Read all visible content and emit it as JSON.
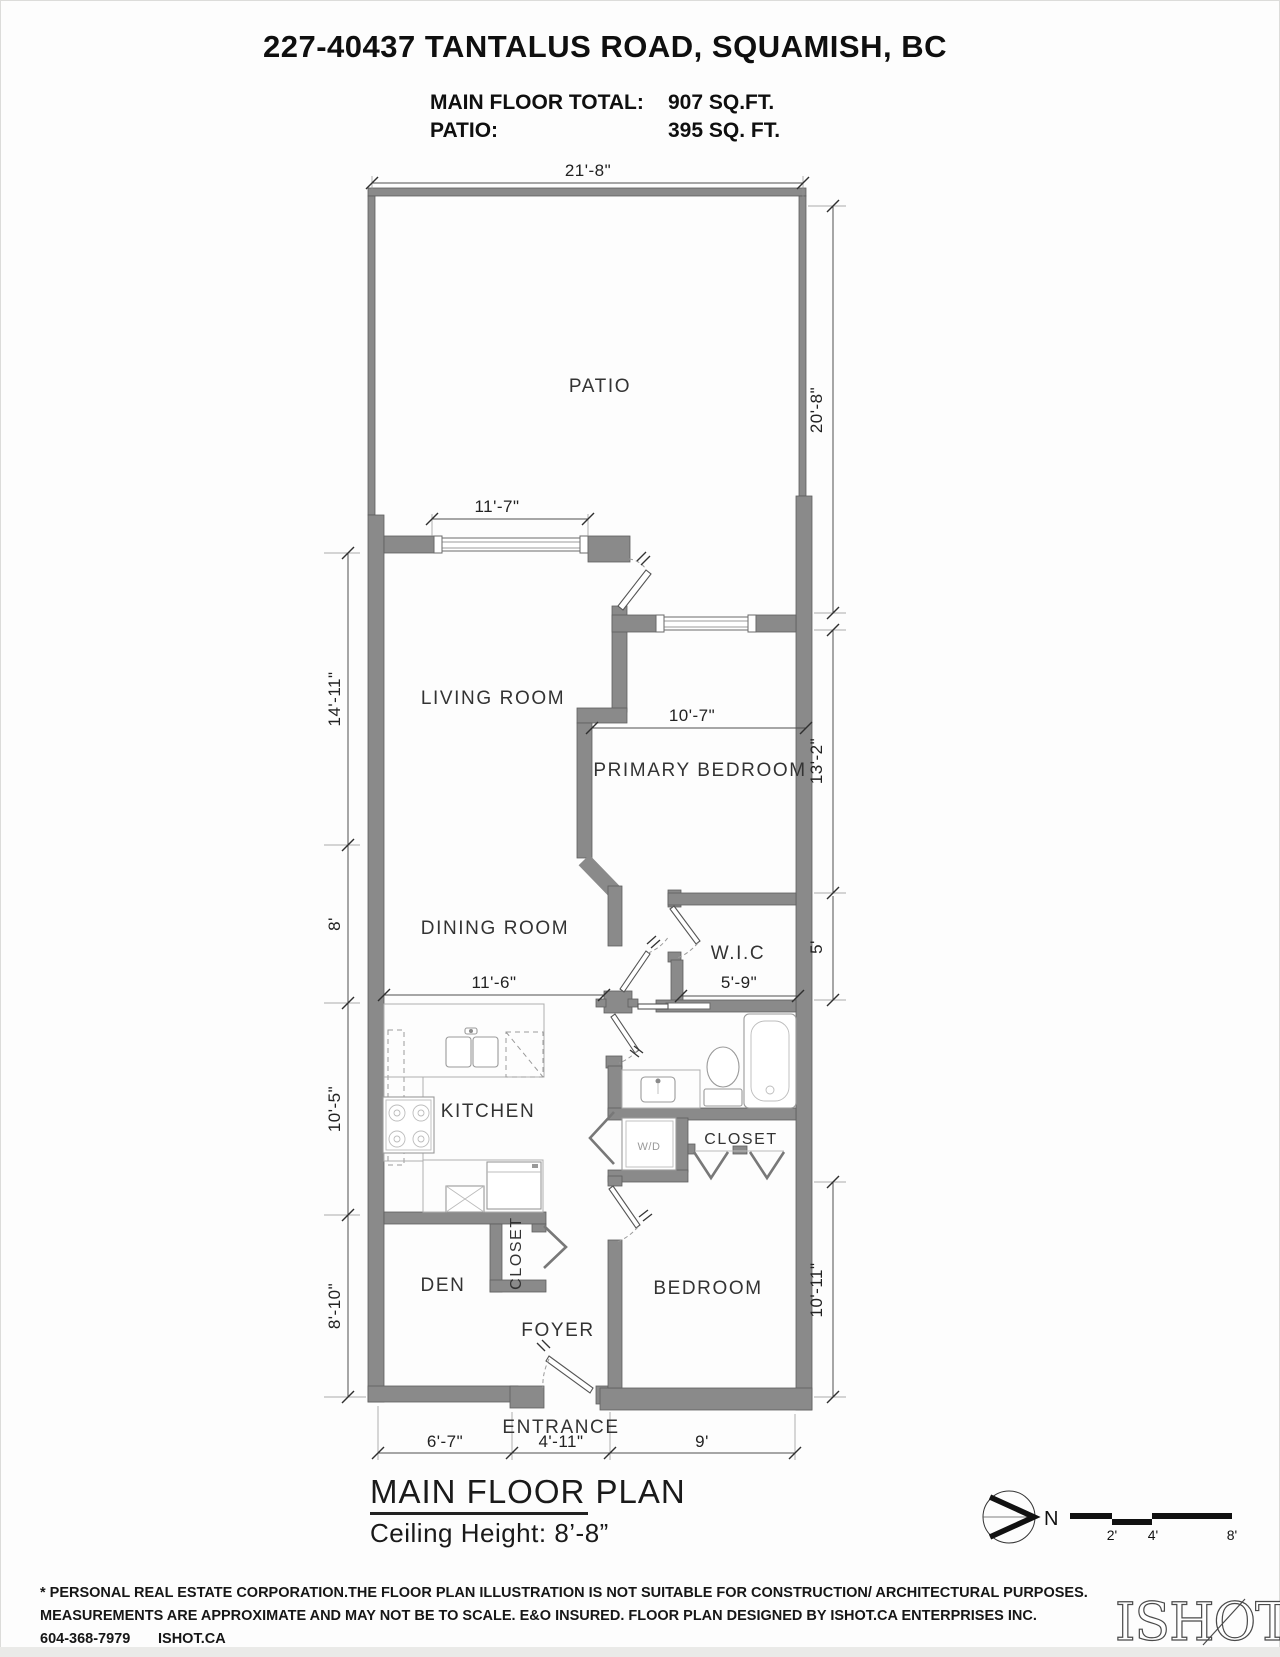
{
  "header": {
    "title": "227-40437 TANTALUS ROAD, SQUAMISH, BC",
    "stats": [
      {
        "label": "MAIN FLOOR TOTAL:",
        "value": "907 SQ.FT."
      },
      {
        "label": "PATIO:",
        "value": "395 SQ. FT."
      }
    ]
  },
  "plan": {
    "rooms": {
      "patio": "PATIO",
      "living_room": "LIVING ROOM",
      "primary_bedroom": "PRIMARY BEDROOM",
      "dining_room": "DINING ROOM",
      "wic": "W.I.C",
      "kitchen": "KITCHEN",
      "bedroom_closet": "CLOSET",
      "bedroom": "BEDROOM",
      "den": "DEN",
      "foyer_closet": "CLOSET",
      "foyer": "FOYER",
      "entrance": "ENTRANCE",
      "washer_dryer": "W/D"
    },
    "dims": {
      "patio_w": "21'-8\"",
      "patio_h": "20'-8\"",
      "living_window": "11'-7\"",
      "living_h": "14'-11\"",
      "primary_w": "10'-7\"",
      "primary_h": "13'-2\"",
      "dining_h": "8'",
      "dining_w": "11'-6\"",
      "wic_w": "5'-9\"",
      "wic_h": "5'",
      "kitchen_h": "10'-5\"",
      "den_h": "8'-10\"",
      "bedroom_h": "10'-11\"",
      "den_w": "6'-7\"",
      "entrance_w": "4'-11\"",
      "bedroom_w": "9'"
    },
    "footer": {
      "plan_title": "MAIN FLOOR PLAN",
      "ceiling": "Ceiling Height: 8’-8”"
    }
  },
  "compass": {
    "north": "N"
  },
  "scale_bar": {
    "ticks": [
      "2'",
      "4'",
      "8'"
    ]
  },
  "disclaimer": {
    "line1": "* PERSONAL REAL ESTATE CORPORATION.THE FLOOR PLAN ILLUSTRATION IS NOT SUITABLE FOR CONSTRUCTION/ ARCHITECTURAL PURPOSES.",
    "line2": "MEASUREMENTS ARE APPROXIMATE AND MAY NOT BE TO SCALE. E&O INSURED. FLOOR PLAN DESIGNED BY ISHOT.CA ENTERPRISES INC.",
    "line3_phone": "604-368-7979",
    "line3_site": "ISHOT.CA"
  },
  "logo": {
    "text": "ISHOT"
  },
  "colors": {
    "wall": "#8a8a8a",
    "line": "#4a4a4a",
    "text": "#222222"
  }
}
